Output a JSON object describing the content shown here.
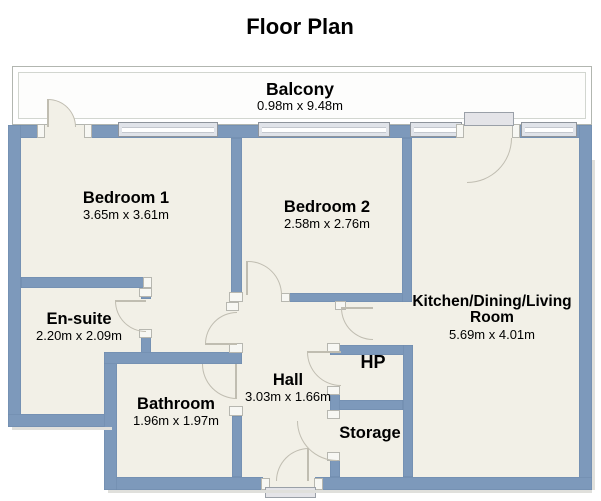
{
  "title": "Floor Plan",
  "colors": {
    "wall": "#7d99bb",
    "walledge": "#6d89ab",
    "floor": "#f2f0e7",
    "win": "#e0e3e9",
    "arcline": "#c0bdb1"
  },
  "balcony": {
    "name": "Balcony",
    "dims": "0.98m x 9.48m"
  },
  "rooms": [
    {
      "name": "Bedroom 1",
      "dims": "3.65m x 3.61m"
    },
    {
      "name": "Bedroom 2",
      "dims": "2.58m x 2.76m"
    },
    {
      "name": "Kitchen/Dining/Living Room",
      "dims": "5.69m x 4.01m"
    },
    {
      "name": "En-suite",
      "dims": "2.20m x 2.09m"
    },
    {
      "name": "Bathroom",
      "dims": "1.96m x 1.97m"
    },
    {
      "name": "Hall",
      "dims": "3.03m x 1.66m"
    },
    {
      "name": "HP",
      "dims": ""
    },
    {
      "name": "Storage",
      "dims": ""
    }
  ]
}
